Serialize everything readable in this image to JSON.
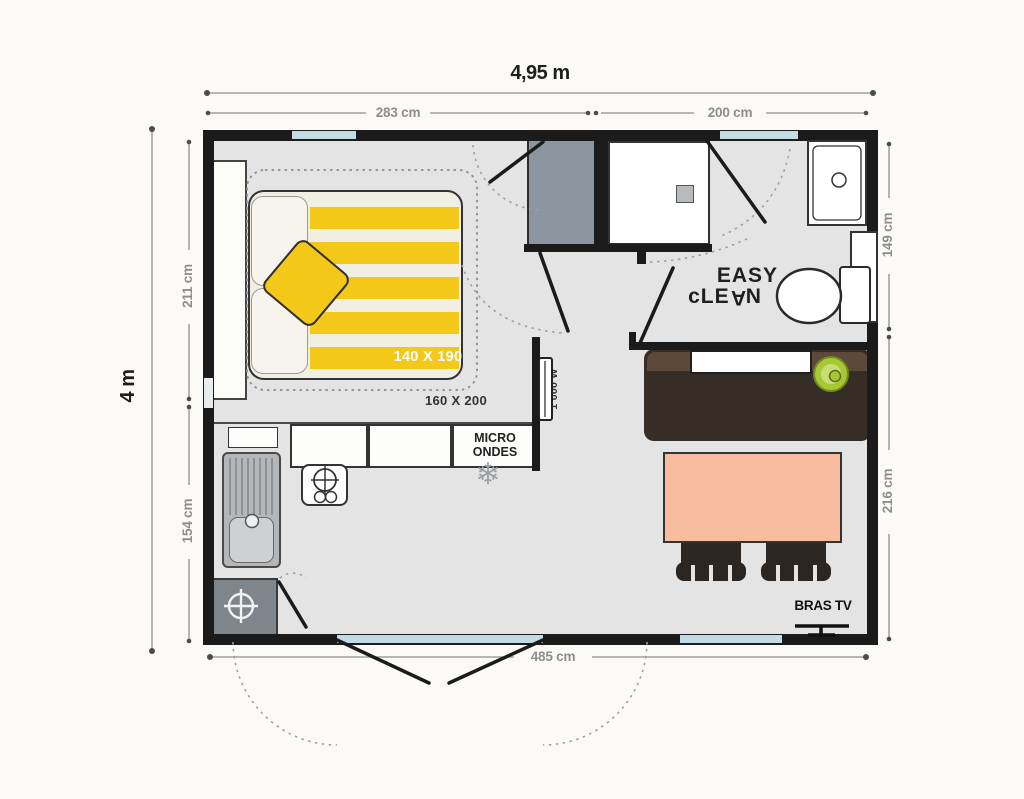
{
  "dimensions": {
    "overall_width": "4,95 m",
    "overall_height": "4 m",
    "top_left": "283 cm",
    "top_right": "200 cm",
    "left_upper": "211 cm",
    "left_lower": "154 cm",
    "right_upper": "149 cm",
    "right_lower": "216 cm",
    "bottom": "485 cm"
  },
  "labels": {
    "bed_size": "140 X 190",
    "rug_size": "160 X 200",
    "microwave_line1": "MICRO",
    "microwave_line2": "ONDES",
    "heater_power": "1 000 W",
    "easy": "EASY",
    "clean_pre": "cLE",
    "clean_a": "A",
    "clean_post": "N",
    "tv_bracket": "BRAS TV"
  },
  "icons": {
    "freezer_glyph": "❄"
  },
  "colors": {
    "page_bg": "#fbfaf7",
    "floor": "#e3e4e3",
    "wall": "#1b1b1b",
    "window": "#c3dbe2",
    "accent_yellow": "#f4c818",
    "wardrobe": "#8c96a0",
    "tech_gray": "#7e868c",
    "counter_dark": "#362d26",
    "counter_light": "#5d4939",
    "table": "#f7bd9e",
    "chair": "#2b2622",
    "plant_green": "#a6c832"
  }
}
